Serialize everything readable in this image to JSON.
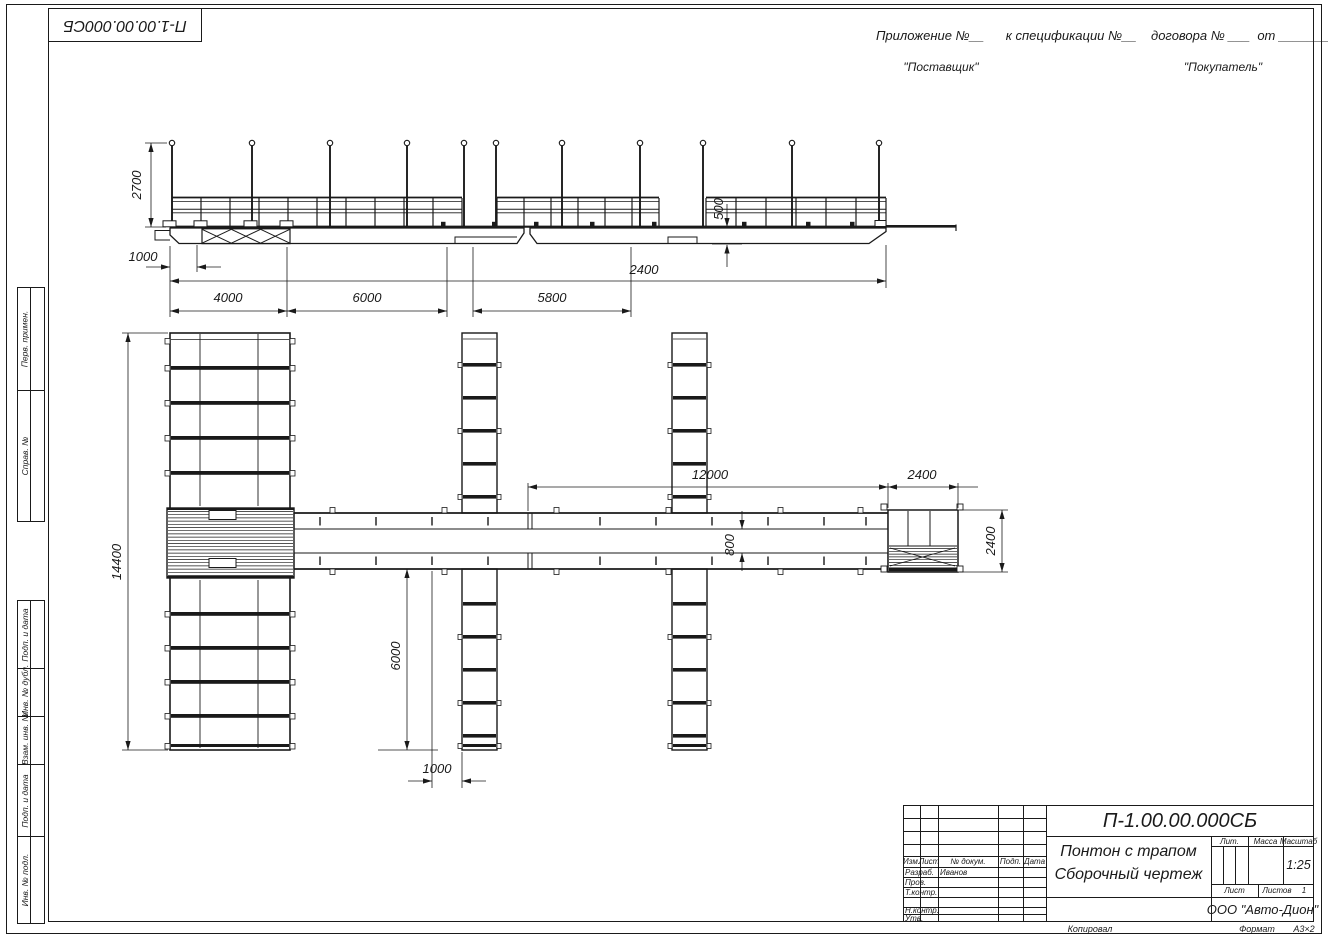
{
  "corner_stamp": {
    "doc_number": "П-1.00.00.000СБ"
  },
  "header": {
    "appendix_line": "Приложение №__      к спецификации №__    договора № ___  от ________",
    "supplier": "\"Поставщик\"",
    "buyer": "\"Покупатель\""
  },
  "margin_labels": {
    "perv_primen": "Перв. примен.",
    "sprav_no": "Справ. №",
    "podp_i_data_1": "Подп. и дата",
    "inv_no_dubl": "Инв. № дубл.",
    "vzam_inv_no": "Взам. инв. №",
    "podp_i_data_2": "Подп. и дата",
    "inv_no_podl": "Инв. № подл."
  },
  "dims": {
    "d2700": "2700",
    "d500": "500",
    "d1000_side": "1000",
    "d2400_side": "2400",
    "d4000": "4000",
    "d6000_side": "6000",
    "d5800": "5800",
    "d12000": "12000",
    "d2400_top": "2400",
    "d14400": "14400",
    "d6000_plan": "6000",
    "d1000_plan": "1000",
    "d800": "800",
    "d2400_right": "2400"
  },
  "title_block": {
    "doc_number": "П-1.00.00.000СБ",
    "name_line1": "Понтон с трапом",
    "name_line2": "Сборочный чертеж",
    "col_izm": "Изм.",
    "col_list": "Лист",
    "col_dokum": "№ докум.",
    "col_podp": "Подп.",
    "col_data": "Дата",
    "row_razrab": "Разраб.",
    "razrab_name": "Иванов",
    "row_prov": "Пров.",
    "row_tkontr": "Т.контр.",
    "row_nkontr": "Н.контр.",
    "row_utv": "Утв.",
    "lit_label": "Лит.",
    "massa_label": "Масса",
    "masshtab_label": "Масштаб",
    "scale_value": "1:25",
    "list_label": "Лист",
    "listov_label": "Листов",
    "listov_value": "1",
    "company": "ООО \"Авто-Дион\"",
    "footer_kopiroval": "Копировал",
    "footer_format_label": "Формат",
    "footer_format_value": "А3×2"
  },
  "colors": {
    "line": "#1a1a1a",
    "background": "#ffffff"
  }
}
